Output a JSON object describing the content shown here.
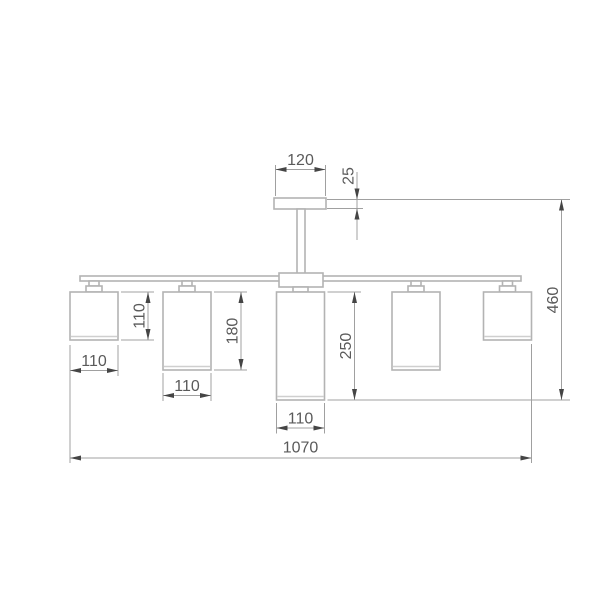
{
  "drawing": {
    "type": "technical-dimension-drawing",
    "subject": "five-light ceiling chandelier, front elevation",
    "colors": {
      "background": "#ffffff",
      "fixture_line": "#b3b3b3",
      "dimension_line": "#a0a0a0",
      "arrow": "#454545",
      "text": "#5a5a5a"
    },
    "labels": {
      "canopy_width": "120",
      "canopy_thickness": "25",
      "shade_small_height": "110",
      "shade_medium_height": "180",
      "shade_center_height": "250",
      "overall_height": "460",
      "shade_width_left": "110",
      "shade_width_mid": "110",
      "shade_width_center": "110",
      "overall_width": "1070"
    }
  }
}
